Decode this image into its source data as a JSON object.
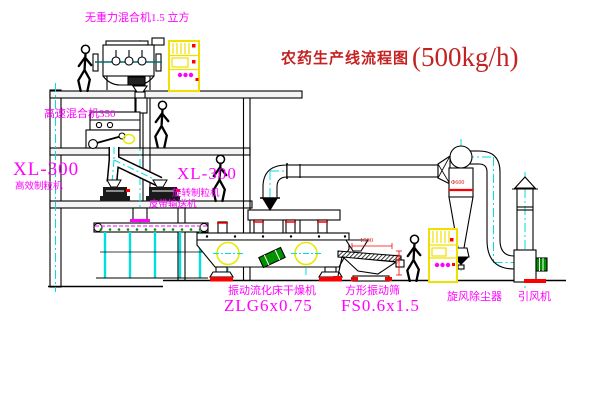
{
  "title": {
    "text": "农药生产线流程图",
    "capacity": "(500kg/h)"
  },
  "equipment_labels": {
    "gravity_mixer": "无重力混合机1.5 立方",
    "high_speed_mixer": "高速混合机350",
    "granulator_left_model": "XL-300",
    "granulator_left_name": "高效制粒机",
    "granulator_center_model": "XL-300",
    "granulator_center_name": "旋转制粒机",
    "belt_conveyor": "皮带输送机",
    "dryer_name": "振动流化床干燥机",
    "dryer_model": "ZLG6x0.75",
    "sieve_name": "方形振动筛",
    "sieve_model": "FS0.6x1.5",
    "cyclone": "旋风除尘器",
    "fan": "引风机"
  },
  "dimensions": {
    "sieve_width": "1500",
    "sieve_height": "545",
    "cyclone_dia": "Φ600"
  },
  "colors": {
    "labels": "#ff00ff",
    "title": "#c42222",
    "centerline": "#00e0e0",
    "cabinet": "#f0e000",
    "accent_red": "#ff0000",
    "motor_green": "#009000",
    "line": "#000000"
  }
}
